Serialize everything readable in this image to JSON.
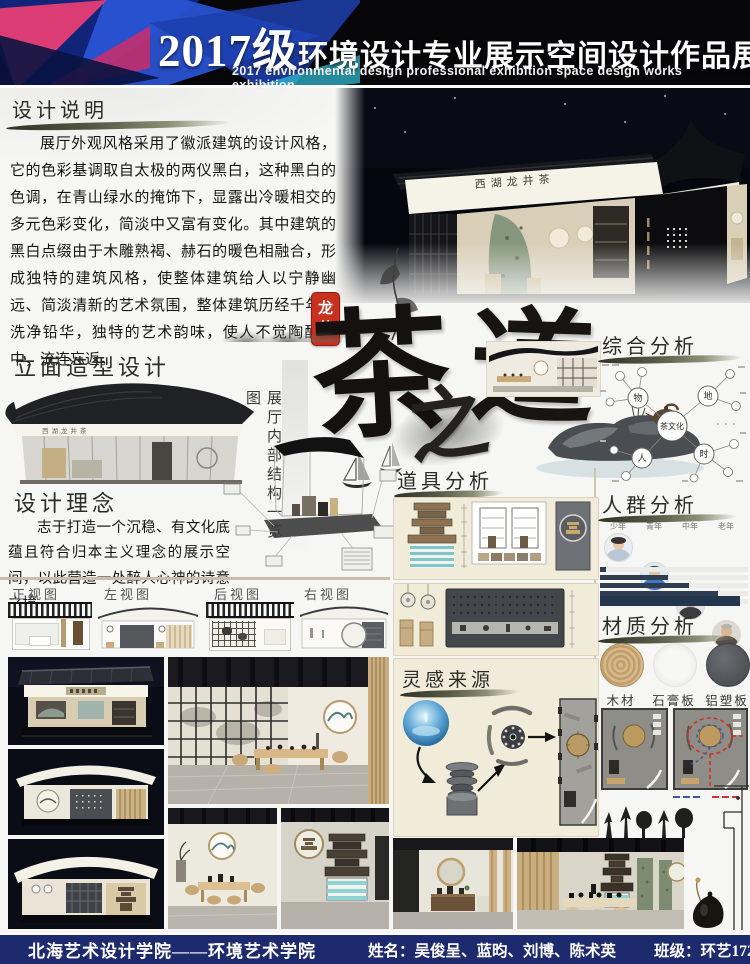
{
  "header": {
    "year": "2017级",
    "title": "环境设计专业展示空间设计作品展",
    "subtitle": "2017 environmental design professional exhibition space design works exhibition"
  },
  "design_description": {
    "title": "设计说明",
    "body": "展厅外观风格采用了徽派建筑的设计风格，它的色彩基调取自太极的两仪黑白，这种黑白的色调，在青山绿水的掩饰下，显露出冷暖相交的多元色彩变化，简淡中又富有变化。其中建筑的黑白点缀由于木雕熟褐、赫石的暖色相融合，形成独特的建筑风格，使整体建筑给人以宁静幽远、简淡清新的艺术氛围，整体建筑历经千年，洗净铅华，独特的艺术韵味，使人不觉陶醉其中，流连忘返。"
  },
  "seal": {
    "line1": "龙",
    "line2": "井"
  },
  "calligraphy": {
    "char1": "茶",
    "char2": "之",
    "char3": "道"
  },
  "building_sign": "西湖龙井茶",
  "facade": {
    "title": "立面造型设计"
  },
  "structure_label": "展厅内部结构一览图",
  "concept": {
    "title": "设计理念",
    "body": "志于打造一个沉稳、有文化底蕴且符合归本主义理念的展示空间，以此营造一处醉人心神的诗意之境。"
  },
  "elevations": {
    "front": "正视图",
    "left": "左视图",
    "back": "后视图",
    "right": "右视图"
  },
  "props": {
    "title": "道具分析"
  },
  "inspiration": {
    "title": "灵感来源"
  },
  "analysis": {
    "title": "综合分析",
    "center": "茶文化",
    "node_wu": "物",
    "node_di": "地",
    "node_ren": "人",
    "node_shi": "时"
  },
  "crowd": {
    "title": "人群分析",
    "groups": [
      "少年",
      "青年",
      "中年",
      "老年"
    ],
    "bars": [
      4,
      46,
      60,
      80,
      76
    ]
  },
  "material": {
    "title": "材质分析",
    "items": [
      {
        "name": "木材"
      },
      {
        "name": "石膏板"
      },
      {
        "name": "铝塑板"
      }
    ]
  },
  "footer": {
    "school": "北海艺术设计学院——环境艺术学院",
    "names": "姓名：吴俊呈、蓝昀、刘博、陈术英",
    "class_name": "班级：环艺1720班"
  },
  "colors": {
    "accent_red": "#c9301e",
    "footer_navy": "#1e2a6e",
    "bar_navy": "#2e3d52",
    "panel_beige": "#f1ebda",
    "night": "#070a14"
  }
}
